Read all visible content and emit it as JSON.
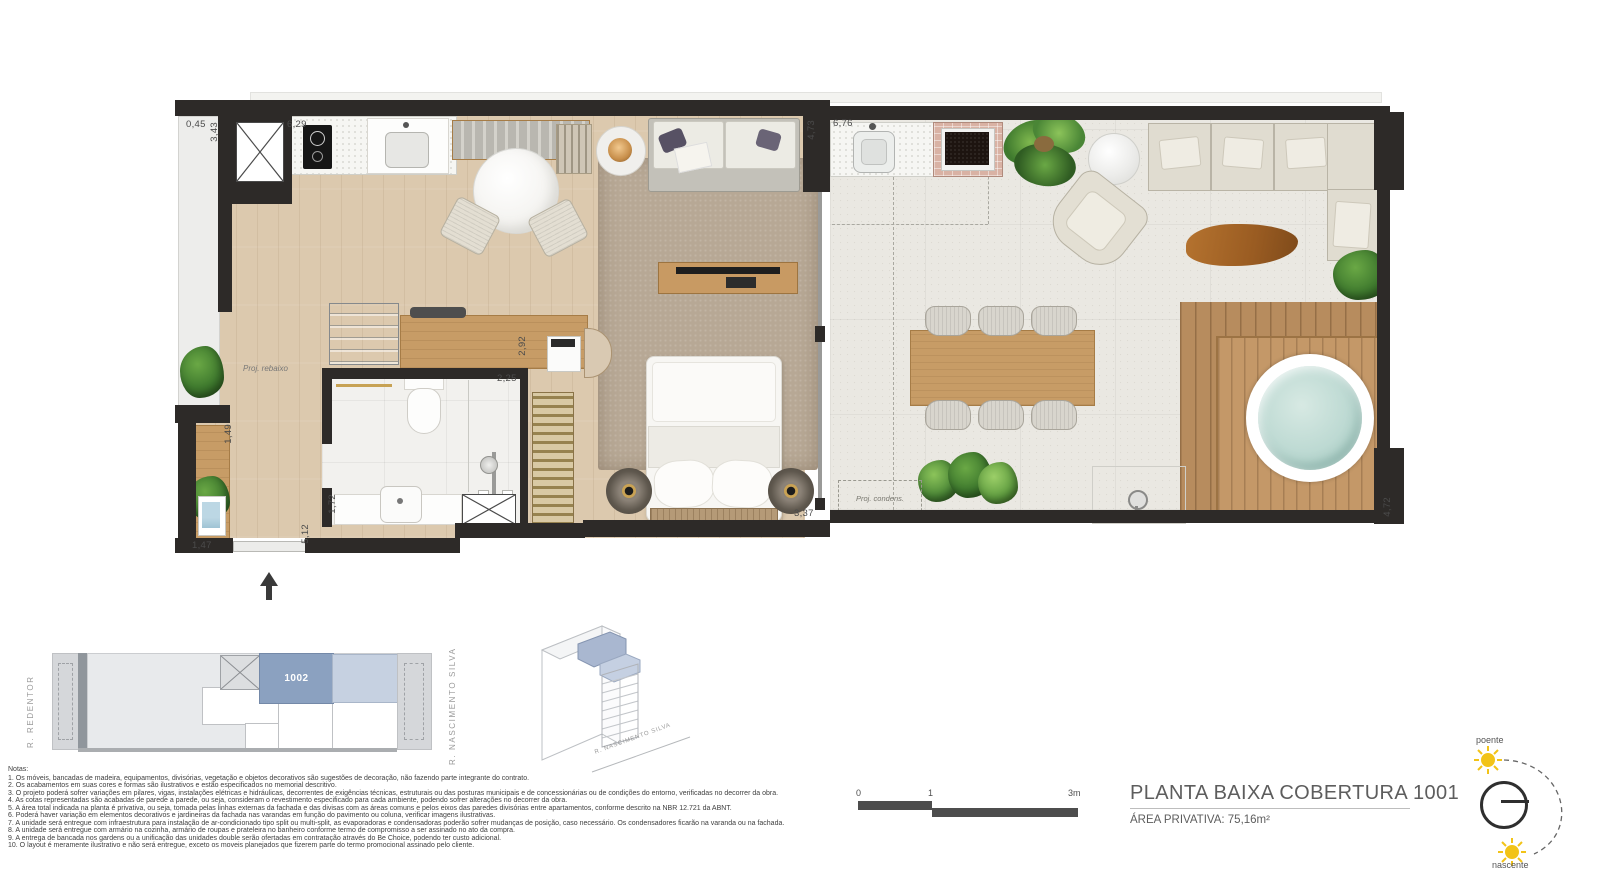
{
  "floor_plan": {
    "annotations": {
      "proj_rebaixo": "Proj. rebaixo",
      "proj_condens": "Proj. condens."
    },
    "dimensions": [
      {
        "text": "0,45",
        "x": 186,
        "y": 119,
        "rot": 0
      },
      {
        "text": "3,43",
        "x": 209,
        "y": 122,
        "rot": 90
      },
      {
        "text": "6,29",
        "x": 287,
        "y": 119,
        "rot": 0
      },
      {
        "text": "4,73",
        "x": 806,
        "y": 120,
        "rot": 90
      },
      {
        "text": "6,76",
        "x": 833,
        "y": 118,
        "rot": 0
      },
      {
        "text": "2,92",
        "x": 517,
        "y": 336,
        "rot": 90
      },
      {
        "text": "2,25",
        "x": 497,
        "y": 373,
        "rot": 0
      },
      {
        "text": "1,72",
        "x": 327,
        "y": 494,
        "rot": 90
      },
      {
        "text": "1,49",
        "x": 223,
        "y": 424,
        "rot": 90
      },
      {
        "text": "1,47",
        "x": 192,
        "y": 540,
        "rot": 0
      },
      {
        "text": "5,12",
        "x": 300,
        "y": 524,
        "rot": 90
      },
      {
        "text": "3,37",
        "x": 794,
        "y": 508,
        "rot": 0
      },
      {
        "text": "4,72",
        "x": 1382,
        "y": 497,
        "rot": 90
      }
    ]
  },
  "key_plan": {
    "street_left": "R. REDENTOR",
    "street_right": "R. NASCIMENTO SILVA",
    "unit_label": "1002",
    "highlight_color": "#8ba1c0",
    "secondary_color": "#c6d1e1"
  },
  "iso_plan": {
    "street_label": "R. NASCIMENTO SILVA"
  },
  "notes": {
    "heading": "Notas:",
    "items": [
      "1. Os móveis, bancadas de madeira, equipamentos, divisórias, vegetação e objetos decorativos são sugestões de decoração, não fazendo parte integrante do contrato.",
      "2. Os acabamentos em suas cores e formas são ilustrativos e estão especificados no memorial descritivo.",
      "3. O projeto poderá sofrer variações em pilares, vigas, instalações elétricas e hidráulicas, decorrentes de exigências técnicas, estruturais ou das posturas municipais e de concessionárias ou de condições do entorno, verificadas no decorrer da obra.",
      "4. As cotas representadas são acabadas de parede a parede, ou seja, consideram o revestimento especificado para cada ambiente, podendo sofrer alterações no decorrer da obra.",
      "5. A área total indicada na planta é privativa, ou seja, tomada pelas linhas externas da fachada e das divisas com as áreas comuns e pelos eixos das paredes divisórias entre apartamentos, conforme descrito na NBR 12.721 da ABNT.",
      "6. Poderá haver variação em elementos decorativos e jardineiras da fachada nas varandas em função do pavimento ou coluna, verificar imagens ilustrativas.",
      "7. A unidade será entregue com infraestrutura para instalação de ar-condicionado tipo split ou multi-split, as evaporadoras e condensadoras poderão sofrer mudanças de posição, caso necessário. Os condensadores ficarão na varanda ou na fachada.",
      "8. A unidade será entregue com armário na cozinha, armário de roupas e prateleira no banheiro conforme termo de compromisso a ser assinado no ato da compra.",
      "9. A entrega de bancada nos gardens ou a unificação das unidades double serão ofertadas em contratação através do Be Choice, podendo ter custo adicional.",
      "10. O layout é meramente ilustrativo e não será entregue, exceto os moveis planejados que fizerem parte do termo promocional assinado pelo cliente."
    ]
  },
  "scale_bar": {
    "tick0": "0",
    "tick1": "1",
    "tick2": "3m"
  },
  "title_block": {
    "title": "PLANTA BAIXA COBERTURA 1001",
    "area": "ÁREA PRIVATIVA: 75,16m²"
  },
  "compass": {
    "west": "poente",
    "east": "nascente",
    "sun_color": "#f2c318"
  }
}
